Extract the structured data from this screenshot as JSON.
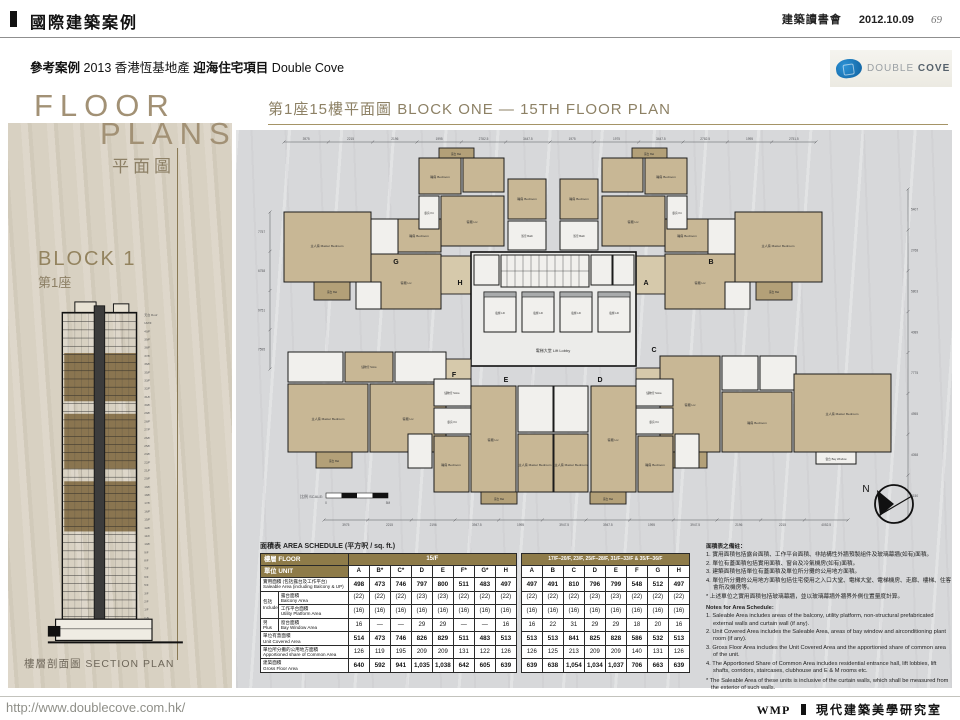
{
  "header": {
    "bar_title": "國際建築案例",
    "club": "建築讀書會",
    "date": "2012.10.09",
    "page_number": "69"
  },
  "subheader": {
    "label": "參考案例",
    "year": "2013",
    "developer": "香港恆基地產",
    "project_zh": "迎海住宅項目",
    "project_en": "Double Cove"
  },
  "logo": {
    "word1": "DOUBLE",
    "word2": "COVE",
    "color_primary": "#1d7dc2",
    "color_dark": "#0f5f9d"
  },
  "sidebar": {
    "title_line1": "FLOOR",
    "title_line2": "PLANS",
    "title_zh": "平面圖",
    "block_en": "BLOCK 1",
    "block_zh": "第1座",
    "section_caption": "樓層剖面圖 SECTION PLAN",
    "floors": [
      "天台 Roof",
      "UM/F",
      "40/F",
      "39/F",
      "38/F",
      "37/F",
      "36/F",
      "35/F",
      "33/F",
      "32/F",
      "31/F",
      "30/F",
      "29/F",
      "28/F",
      "27/F",
      "26/F",
      "25/F",
      "23/F",
      "22/F",
      "21/F",
      "20/F",
      "19/F",
      "18/F",
      "17/F",
      "16/F",
      "15/F",
      "12/F",
      "11/F",
      "10/F",
      "9/F",
      "8/F",
      "7/F",
      "6/F",
      "5/F",
      "3/F",
      "2/F",
      "1/F",
      "G/F"
    ]
  },
  "plan": {
    "title_zh": "第1座15樓平面圖",
    "title_en": "BLOCK ONE — 15TH FLOOR PLAN",
    "scale_label": "比例 SCALE:",
    "scale_start": "0",
    "scale_end": "5M",
    "north_label": "N",
    "core": {
      "lift": "電梯 Lift",
      "lobby": "電梯大堂 Lift Lobby"
    },
    "unit_letters": [
      "H",
      "A",
      "G",
      "B",
      "F",
      "C",
      "E",
      "D"
    ],
    "room_labels": {
      "master": "主人房 Master Bedroom",
      "bedroom": "睡房 Bedroom",
      "living": "客廳 Liv",
      "dining": "飯廳 Din",
      "kitchen": "廚房 Kit",
      "bath": "浴室 Bath",
      "store": "儲物室 Store",
      "balcony": "露台 Bal",
      "up": "工作平台 U.P.",
      "bay": "窗台 Bay Window"
    },
    "dimensions_top": [
      "3975",
      "2215",
      "2196",
      "1995",
      "2782.5",
      "3447.5",
      "1975",
      "1975",
      "3447.5",
      "2782.5",
      "1995",
      "2751.5"
    ],
    "dimensions_bottom": [
      "3975",
      "2215",
      "2196",
      "3947.5",
      "1995",
      "3947.5",
      "3947.5",
      "1995",
      "3947.5",
      "2196",
      "2215",
      "4052.5"
    ],
    "dimensions_right": [
      "5407",
      "2768",
      "5803",
      "4089",
      "7775",
      "4955",
      "4058",
      "3150"
    ],
    "dimensions_left": [
      "7757",
      "6758",
      "9751",
      "7595"
    ]
  },
  "schedule": {
    "title": "面積表 AREA SCHEDULE (平方呎 / sq. ft.)",
    "floor_header": "樓層 FLOOR",
    "unit_header": "單位 UNIT",
    "group1": "15/F",
    "group2": "17/F–20/F, 23/F, 25/F–28/F, 31/F–33/F & 35/F–36/F",
    "units_g1": [
      "A",
      "B*",
      "C*",
      "D",
      "E",
      "F*",
      "G*",
      "H"
    ],
    "units_g2": [
      "A",
      "B",
      "C",
      "D",
      "E",
      "F",
      "G",
      "H"
    ],
    "rows": [
      {
        "label_zh": "實用面積 (包括露台及工作平台)",
        "label_en": "Saleable Area (including Balcony & UP)",
        "bold": true,
        "g1": [
          "498",
          "473",
          "746",
          "797",
          "800",
          "511",
          "483",
          "497"
        ],
        "g2": [
          "497",
          "491",
          "810",
          "796",
          "799",
          "548",
          "512",
          "497"
        ]
      },
      {
        "prefix_zh": "包括",
        "prefix_en": "Include",
        "label_zh": "露台面積",
        "label_en": "Balcony Area",
        "bold": false,
        "g1": [
          "(22)",
          "(22)",
          "(22)",
          "(23)",
          "(23)",
          "(22)",
          "(22)",
          "(22)"
        ],
        "g2": [
          "(22)",
          "(22)",
          "(22)",
          "(23)",
          "(23)",
          "(22)",
          "(22)",
          "(22)"
        ]
      },
      {
        "label_zh": "工作平台面積",
        "label_en": "Utility Platform Area",
        "bold": false,
        "g1": [
          "(16)",
          "(16)",
          "(16)",
          "(16)",
          "(16)",
          "(16)",
          "(16)",
          "(16)"
        ],
        "g2": [
          "(16)",
          "(16)",
          "(16)",
          "(16)",
          "(16)",
          "(16)",
          "(16)",
          "(16)"
        ]
      },
      {
        "prefix_zh": "另",
        "prefix_en": "Plus",
        "label_zh": "窗台面積",
        "label_en": "Bay Window Area",
        "bold": false,
        "g1": [
          "16",
          "—",
          "—",
          "29",
          "29",
          "—",
          "—",
          "16"
        ],
        "g2": [
          "16",
          "22",
          "31",
          "29",
          "29",
          "18",
          "20",
          "16"
        ]
      },
      {
        "label_zh": "單位有蓋面積",
        "label_en": "Unit Covered Area",
        "bold": true,
        "g1": [
          "514",
          "473",
          "746",
          "826",
          "829",
          "511",
          "483",
          "513"
        ],
        "g2": [
          "513",
          "513",
          "841",
          "825",
          "828",
          "586",
          "532",
          "513"
        ]
      },
      {
        "label_zh": "單位所分攤的公用地方面積",
        "label_en": "Apportioned share of Common Area",
        "bold": false,
        "g1": [
          "126",
          "119",
          "195",
          "209",
          "209",
          "131",
          "122",
          "126"
        ],
        "g2": [
          "126",
          "125",
          "213",
          "209",
          "209",
          "140",
          "131",
          "126"
        ]
      },
      {
        "label_zh": "建築面積",
        "label_en": "Gross Floor Area",
        "bold": true,
        "g1": [
          "640",
          "592",
          "941",
          "1,035",
          "1,038",
          "642",
          "605",
          "639"
        ],
        "g2": [
          "639",
          "638",
          "1,054",
          "1,034",
          "1,037",
          "706",
          "663",
          "639"
        ]
      }
    ]
  },
  "notes": {
    "title_zh": "面積表之備註：",
    "items_zh": [
      "實用面積包括露台面積、工作平台面積、非結構性外牆預製組件及玻璃幕牆(如有)面積。",
      "單位有蓋面積包括實用面積、窗台及冷氣機房(如有)面積。",
      "建築面積包括單位有蓋面積及單位所分攤的公用地方面積。",
      "單位所分攤的公用地方面積包括住宅使用之入口大堂、電梯大堂、電梯機房、走廊、樓梯、住客會所及機房等。"
    ],
    "star_zh": "* 上述單位之實用面積包括玻璃幕牆，並以玻璃幕牆外牆界外側位置量度計算。",
    "title_en": "Notes for Area Schedule:",
    "items_en": [
      "Saleable Area includes areas of the balcony, utility platform, non-structural prefabricated external walls and curtain wall (if any).",
      "Unit Covered Area includes the Saleable Area, areas of bay window and airconditioning plant room (if any).",
      "Gross Floor Area includes the Unit Covered Area and the apportioned share of common area of the unit.",
      "The Apportioned Share of Common Area includes residential entrance hall, lift lobbies, lift shafts, corridors, staircases, clubhouse and E & M rooms etc."
    ],
    "star_en": "* The Saleable Area of these units is inclusive of the curtain walls, which shall be measured from the exterior of such walls."
  },
  "footer": {
    "url": "http://www.doublecove.com.hk/",
    "brand": "WMP",
    "studio": "現代建築美學研究室"
  }
}
